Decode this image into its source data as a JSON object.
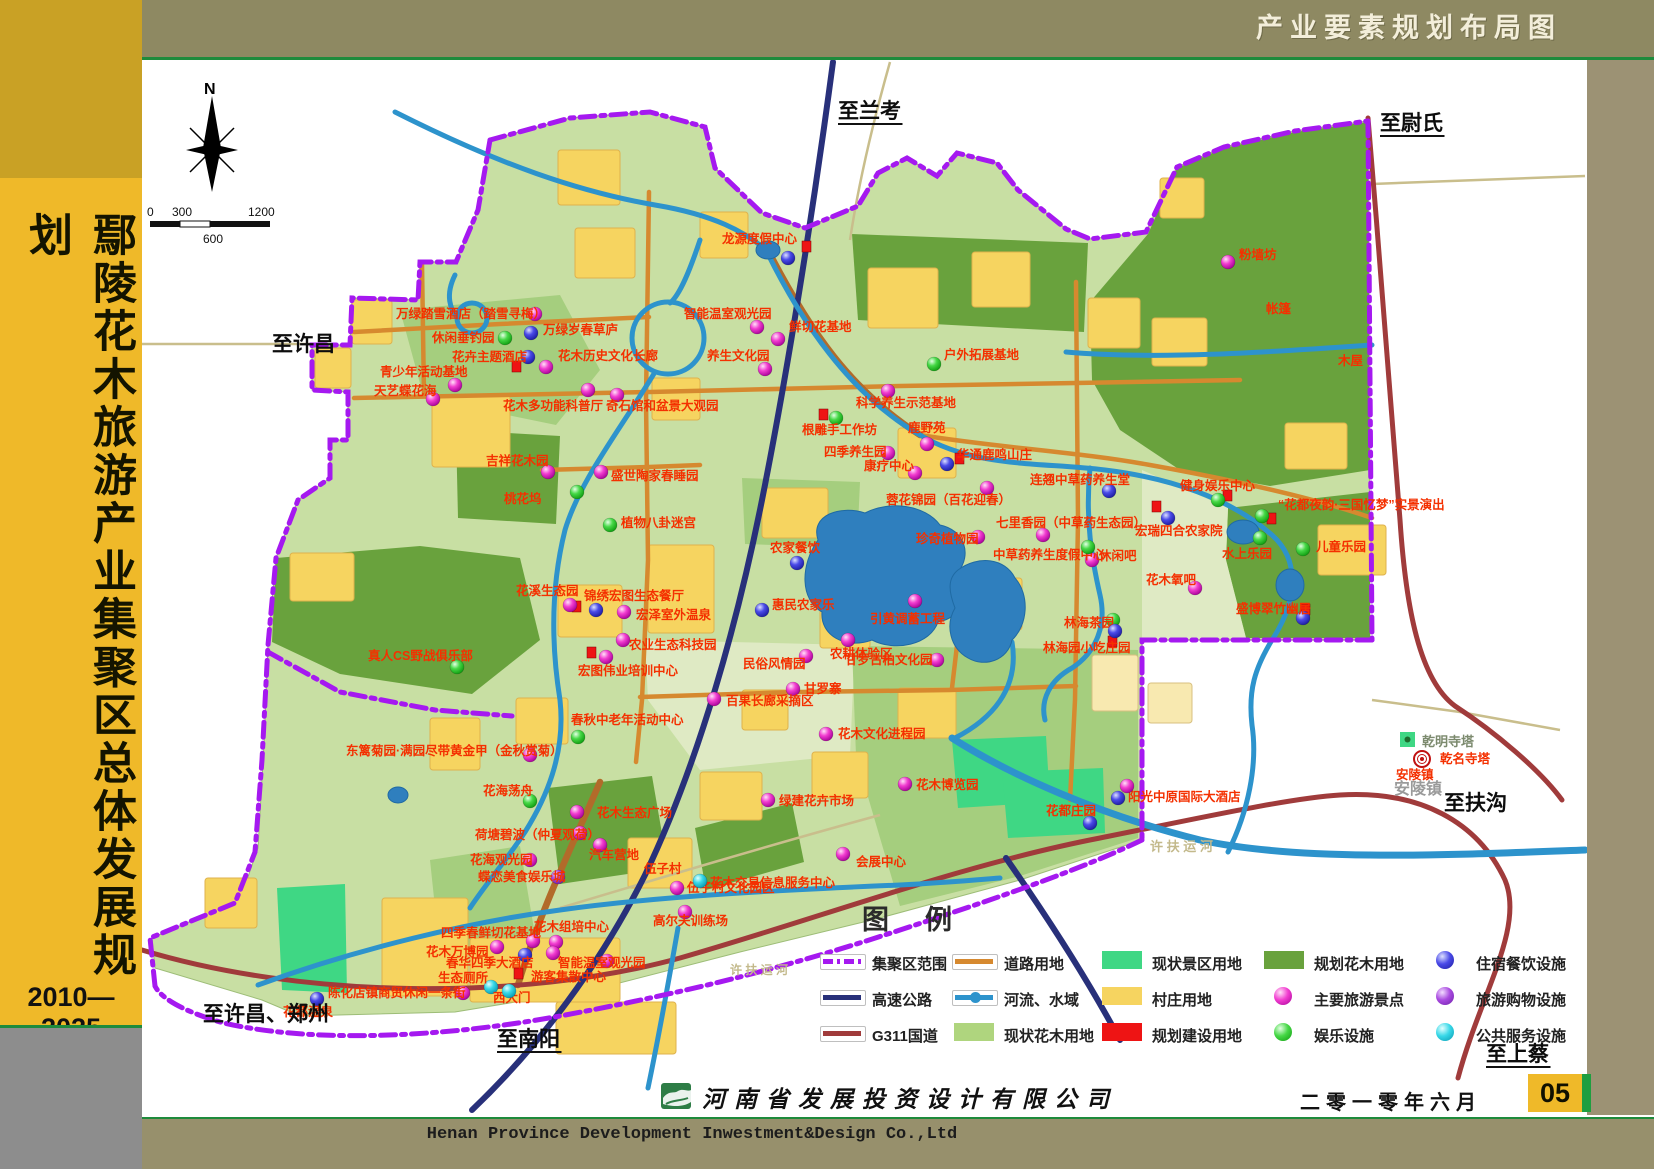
{
  "top_bar": {
    "title": "产业要素规划布局图"
  },
  "sidebar": {
    "title": "鄢陵花木旅游产业集聚区总体发展规划",
    "years": "2010—2025"
  },
  "footer": {
    "company_cn": "河南省发展投资设计有限公司",
    "company_en": "Henan Province Development Inwestment&Design Co.,Ltd",
    "date": "二零一零年六月",
    "page_number": "05"
  },
  "legend": {
    "title": "图例",
    "columns": [
      {
        "x": 820,
        "items": [
          {
            "sw": "line-boundary",
            "label": "集聚区范围"
          },
          {
            "sw": "line-highway",
            "label": "高速公路"
          },
          {
            "sw": "line-g311",
            "label": "G311国道"
          }
        ]
      },
      {
        "x": 952,
        "items": [
          {
            "sw": "line-road",
            "label": "道路用地"
          },
          {
            "sw": "line-river",
            "label": "河流、水域"
          },
          {
            "sw": "patch-flower-current",
            "label": "现状花木用地"
          }
        ]
      },
      {
        "x": 1100,
        "items": [
          {
            "sw": "patch-scenic",
            "label": "现状景区用地"
          },
          {
            "sw": "patch-village",
            "label": "村庄用地"
          },
          {
            "sw": "patch-construction",
            "label": "规划建设用地"
          }
        ]
      },
      {
        "x": 1262,
        "items": [
          {
            "sw": "patch-flower-planned",
            "label": "规划花木用地"
          },
          {
            "sw": "ball-magenta",
            "label": "主要旅游景点"
          },
          {
            "sw": "ball-green",
            "label": "娱乐设施"
          }
        ]
      },
      {
        "x": 1424,
        "items": [
          {
            "sw": "ball-blue",
            "label": "住宿餐饮设施"
          },
          {
            "sw": "ball-purple",
            "label": "旅游购物设施"
          },
          {
            "sw": "ball-cyan",
            "label": "公共服务设施"
          }
        ]
      }
    ]
  },
  "map": {
    "compass_n": "N",
    "scale": {
      "t0": "0",
      "t1": "300",
      "t2": "1200",
      "mid": "600"
    },
    "directions": [
      {
        "t": "至兰考",
        "x": 838,
        "y": 118,
        "u": true
      },
      {
        "t": "至尉氏",
        "x": 1380,
        "y": 130,
        "u": true
      },
      {
        "t": "至许昌",
        "x": 272,
        "y": 351,
        "u": false
      },
      {
        "t": "至扶沟",
        "x": 1444,
        "y": 810,
        "u": false
      },
      {
        "t": "至上蔡",
        "x": 1486,
        "y": 1061,
        "u": true
      },
      {
        "t": "至许昌、郑州",
        "x": 203,
        "y": 1021,
        "u": false
      },
      {
        "t": "至南阳",
        "x": 497,
        "y": 1046,
        "u": true
      }
    ],
    "pois": [
      {
        "l": "龙源度假中心",
        "m": "blue",
        "x": 788,
        "y": 258,
        "lx": 722,
        "ly": 243,
        "rs": [
          806,
          246
        ]
      },
      {
        "l": "万绿踏雪酒店（踏雪寻梅）",
        "m": "magenta",
        "x": 535,
        "y": 314,
        "lx": 396,
        "ly": 318
      },
      {
        "l": "休闲垂钓园",
        "m": "green",
        "x": 505,
        "y": 338,
        "lx": 432,
        "ly": 342
      },
      {
        "l": "万绿岁春草庐",
        "m": "blue",
        "x": 531,
        "y": 333,
        "lx": 543,
        "ly": 334
      },
      {
        "l": "花卉主题酒店",
        "m": "blue",
        "x": 528,
        "y": 357,
        "lx": 452,
        "ly": 361,
        "rs": [
          516,
          366
        ]
      },
      {
        "l": "花木历史文化长廊",
        "m": "magenta",
        "x": 546,
        "y": 367,
        "lx": 558,
        "ly": 360
      },
      {
        "l": "智能温室观光园",
        "m": "magenta",
        "x": 757,
        "y": 327,
        "lx": 684,
        "ly": 318
      },
      {
        "l": "鲜切花基地",
        "m": "magenta",
        "x": 778,
        "y": 339,
        "lx": 789,
        "ly": 331
      },
      {
        "l": "养生文化园",
        "m": "magenta",
        "x": 765,
        "y": 369,
        "lx": 707,
        "ly": 360
      },
      {
        "l": "户外拓展基地",
        "m": "green",
        "x": 934,
        "y": 364,
        "lx": 944,
        "ly": 359
      },
      {
        "l": "科学养生示范基地",
        "m": "magenta",
        "x": 888,
        "y": 391,
        "lx": 856,
        "ly": 407
      },
      {
        "l": "根雕手工作坊",
        "m": "green",
        "x": 836,
        "y": 418,
        "lx": 802,
        "ly": 434,
        "rs": [
          823,
          414
        ]
      },
      {
        "l": "鹿野苑",
        "m": "magenta",
        "x": 927,
        "y": 444,
        "lx": 908,
        "ly": 432
      },
      {
        "l": "四季养生园",
        "m": "magenta",
        "x": 888,
        "y": 453,
        "lx": 824,
        "ly": 456
      },
      {
        "l": "康疗中心",
        "m": "magenta",
        "x": 915,
        "y": 473,
        "lx": 864,
        "ly": 470
      },
      {
        "l": "华通鹿鸣山庄",
        "m": "blue",
        "x": 947,
        "y": 464,
        "lx": 957,
        "ly": 459,
        "rs": [
          959,
          458
        ]
      },
      {
        "l": "蓉花锦园（百花迎春）",
        "m": "magenta",
        "x": 987,
        "y": 488,
        "lx": 886,
        "ly": 504
      },
      {
        "l": "连翘中草药养生堂",
        "m": "blue",
        "x": 1109,
        "y": 491,
        "lx": 1030,
        "ly": 484
      },
      {
        "l": "七里香园（中草药生态园）",
        "m": "magenta",
        "x": 1043,
        "y": 535,
        "lx": 996,
        "ly": 527
      },
      {
        "l": "宏瑞四合农家院",
        "m": "blue",
        "x": 1168,
        "y": 518,
        "lx": 1135,
        "ly": 535,
        "rs": [
          1156,
          506
        ]
      },
      {
        "l": "珍奇植物园",
        "m": "magenta",
        "x": 978,
        "y": 537,
        "lx": 916,
        "ly": 543
      },
      {
        "l": "中草药养生度假中心",
        "m": "magenta",
        "x": 1092,
        "y": 560,
        "lx": 993,
        "ly": 559
      },
      {
        "l": "休闲吧",
        "m": "green",
        "x": 1088,
        "y": 547,
        "lx": 1099,
        "ly": 560
      },
      {
        "l": "花木氧吧",
        "m": "magenta",
        "x": 1195,
        "y": 588,
        "lx": 1146,
        "ly": 584
      },
      {
        "l": "宏泽室外温泉",
        "m": "magenta",
        "x": 624,
        "y": 612,
        "lx": 636,
        "ly": 619
      },
      {
        "l": "锦绣宏图生态餐厅",
        "m": "blue",
        "x": 596,
        "y": 610,
        "lx": 584,
        "ly": 600,
        "rs": [
          576,
          606
        ]
      },
      {
        "l": "花溪生态园",
        "m": "magenta",
        "x": 570,
        "y": 605,
        "lx": 516,
        "ly": 595
      },
      {
        "l": "农业生态科技园",
        "m": "magenta",
        "x": 623,
        "y": 640,
        "lx": 629,
        "ly": 649
      },
      {
        "l": "宏图伟业培训中心",
        "m": "magenta",
        "x": 606,
        "y": 657,
        "lx": 578,
        "ly": 675,
        "rs": [
          591,
          652
        ]
      },
      {
        "l": "真人CS野战俱乐部",
        "m": "green",
        "x": 457,
        "y": 667,
        "lx": 368,
        "ly": 660
      },
      {
        "l": "春秋中老年活动中心",
        "m": "green",
        "x": 578,
        "y": 737,
        "lx": 571,
        "ly": 724
      },
      {
        "l": "东篱菊园·满园尽带黄金甲（金秋赏菊）",
        "m": "magenta",
        "x": 530,
        "y": 755,
        "lx": 346,
        "ly": 755
      },
      {
        "l": "花海荡舟",
        "m": "green",
        "x": 530,
        "y": 801,
        "lx": 483,
        "ly": 795
      },
      {
        "l": "花木生态广场",
        "m": "magenta",
        "x": 577,
        "y": 812,
        "lx": 597,
        "ly": 817
      },
      {
        "l": "荷塘碧波（仲夏观荷）",
        "m": "magenta",
        "x": 580,
        "y": 833,
        "lx": 475,
        "ly": 839
      },
      {
        "l": "花海观光园",
        "m": "magenta",
        "x": 530,
        "y": 860,
        "lx": 470,
        "ly": 864
      },
      {
        "l": "蝶恋美食娱乐城",
        "m": "purple",
        "x": 558,
        "y": 877,
        "lx": 478,
        "ly": 881
      },
      {
        "l": "汽车营地",
        "m": "magenta",
        "x": 600,
        "y": 845,
        "lx": 589,
        "ly": 859
      },
      {
        "l": "伍子村",
        "m": "none",
        "lx": 644,
        "ly": 873
      },
      {
        "l": "伍子村文化园区",
        "m": "magenta",
        "x": 677,
        "y": 888,
        "lx": 687,
        "ly": 892
      },
      {
        "l": "高尔夫训练场",
        "m": "magenta",
        "x": 685,
        "y": 912,
        "lx": 653,
        "ly": 925
      },
      {
        "l": "花木交易信息服务中心",
        "m": "cyan",
        "x": 700,
        "y": 881,
        "lx": 710,
        "ly": 887
      },
      {
        "l": "会展中心",
        "m": "magenta",
        "x": 843,
        "y": 854,
        "lx": 856,
        "ly": 866
      },
      {
        "l": "绿建花卉市场",
        "m": "magenta",
        "x": 768,
        "y": 800,
        "lx": 779,
        "ly": 805
      },
      {
        "l": "花木博览园",
        "m": "magenta",
        "x": 905,
        "y": 784,
        "lx": 916,
        "ly": 789
      },
      {
        "l": "花木文化进程园",
        "m": "magenta",
        "x": 826,
        "y": 734,
        "lx": 838,
        "ly": 738
      },
      {
        "l": "甘罗寨",
        "m": "magenta",
        "x": 793,
        "y": 689,
        "lx": 804,
        "ly": 693
      },
      {
        "l": "民俗风情园",
        "m": "magenta",
        "x": 806,
        "y": 656,
        "lx": 743,
        "ly": 668
      },
      {
        "l": "甘罗古柏文化园",
        "m": "magenta",
        "x": 937,
        "y": 660,
        "lx": 845,
        "ly": 664
      },
      {
        "l": "百果长廊采摘区",
        "m": "magenta",
        "x": 714,
        "y": 699,
        "lx": 726,
        "ly": 705
      },
      {
        "l": "农耕体验区",
        "m": "magenta",
        "x": 848,
        "y": 640,
        "lx": 830,
        "ly": 658
      },
      {
        "l": "引黄调蓄工程",
        "m": "magenta",
        "x": 915,
        "y": 601,
        "lx": 870,
        "ly": 623
      },
      {
        "l": "惠民农家乐",
        "m": "blue",
        "x": 762,
        "y": 610,
        "lx": 772,
        "ly": 609
      },
      {
        "l": "农家餐饮",
        "m": "blue",
        "x": 797,
        "y": 563,
        "lx": 770,
        "ly": 552
      },
      {
        "l": "林海茶园",
        "m": "green",
        "x": 1113,
        "y": 620,
        "lx": 1064,
        "ly": 627
      },
      {
        "l": "林海园小吃庄园",
        "m": "blue",
        "x": 1115,
        "y": 631,
        "lx": 1043,
        "ly": 652,
        "rs": [
          1112,
          641
        ]
      },
      {
        "l": "健身娱乐中心",
        "m": "green",
        "x": 1218,
        "y": 500,
        "lx": 1180,
        "ly": 490,
        "rs": [
          1227,
          495
        ]
      },
      {
        "l": "“花都夜韵·三国忆梦”实景演出",
        "m": "green",
        "x": 1262,
        "y": 516,
        "lx": 1278,
        "ly": 509,
        "rs": [
          1271,
          518
        ]
      },
      {
        "l": "儿童乐园",
        "m": "green",
        "x": 1303,
        "y": 549,
        "lx": 1316,
        "ly": 551
      },
      {
        "l": "水上乐园",
        "m": "green",
        "x": 1260,
        "y": 538,
        "lx": 1222,
        "ly": 558
      },
      {
        "l": "盛博翠竹幽居",
        "m": "blue",
        "x": 1303,
        "y": 618,
        "lx": 1236,
        "ly": 613,
        "rs": [
          1305,
          609
        ]
      },
      {
        "l": "花都庄园",
        "m": "blue",
        "x": 1090,
        "y": 823,
        "lx": 1046,
        "ly": 815
      },
      {
        "l": "阳光中原国际大酒店",
        "m": "blue",
        "x": 1118,
        "y": 798,
        "lx": 1128,
        "ly": 801
      },
      {
        "l": "乾名寺塔",
        "m": "target",
        "x": 1422,
        "y": 759,
        "lx": 1440,
        "ly": 763
      },
      {
        "l": "安陵镇",
        "m": "none",
        "lx": 1396,
        "ly": 779
      },
      {
        "l": "花都温泉",
        "m": "blue",
        "x": 317,
        "y": 999,
        "lx": 283,
        "ly": 1016
      },
      {
        "l": "陈化店镇商贸休闲一条街",
        "m": "magenta",
        "x": 463,
        "y": 993,
        "lx": 328,
        "ly": 997
      },
      {
        "l": "生态厕所",
        "m": "cyan",
        "x": 491,
        "y": 987,
        "lx": 438,
        "ly": 982
      },
      {
        "l": "游客集散中心",
        "m": "none",
        "lx": 531,
        "ly": 981,
        "rs": [
          518,
          973
        ]
      },
      {
        "l": "西大门",
        "m": "none",
        "lx": 493,
        "ly": 1002
      },
      {
        "l": "春华四季大酒店",
        "m": "blue",
        "x": 525,
        "y": 955,
        "lx": 446,
        "ly": 967
      },
      {
        "l": "花木万博园",
        "m": "magenta",
        "x": 497,
        "y": 947,
        "lx": 426,
        "ly": 956
      },
      {
        "l": "四季春鲜切花基地",
        "m": "magenta",
        "x": 533,
        "y": 941,
        "lx": 441,
        "ly": 937
      },
      {
        "l": "花木组培中心",
        "m": "magenta",
        "x": 556,
        "y": 942,
        "lx": 534,
        "ly": 931
      },
      {
        "l": "智能温室观光园",
        "m": "magenta",
        "x": 607,
        "y": 961,
        "lx": 558,
        "ly": 967
      },
      {
        "l": "青少年活动基地",
        "m": "magenta",
        "x": 455,
        "y": 385,
        "lx": 380,
        "ly": 376
      },
      {
        "l": "天艺蝶花海",
        "m": "magenta",
        "x": 433,
        "y": 399,
        "lx": 374,
        "ly": 395
      },
      {
        "l": "花木多功能科普厅",
        "m": "magenta",
        "x": 588,
        "y": 390,
        "lx": 503,
        "ly": 410
      },
      {
        "l": "奇石馆和盆景大观园",
        "m": "magenta",
        "x": 617,
        "y": 395,
        "lx": 606,
        "ly": 410
      },
      {
        "l": "吉祥花木园",
        "m": "magenta",
        "x": 548,
        "y": 472,
        "lx": 486,
        "ly": 465
      },
      {
        "l": "盛世陶家春睡园",
        "m": "magenta",
        "x": 601,
        "y": 472,
        "lx": 611,
        "ly": 480
      },
      {
        "l": "桃花坞",
        "m": "green",
        "x": 577,
        "y": 492,
        "lx": 504,
        "ly": 503
      },
      {
        "l": "植物八卦迷宫",
        "m": "green",
        "x": 610,
        "y": 525,
        "lx": 621,
        "ly": 527
      },
      {
        "l": "粉墙坊",
        "m": "magenta",
        "x": 1228,
        "y": 262,
        "lx": 1239,
        "ly": 259
      },
      {
        "l": "帐篷",
        "m": "none",
        "lx": 1266,
        "ly": 313
      },
      {
        "l": "木屋",
        "m": "none",
        "lx": 1338,
        "ly": 365
      }
    ],
    "extra_markers": [
      {
        "m": "magenta",
        "x": 1127,
        "y": 786
      },
      {
        "m": "cyan",
        "x": 509,
        "y": 991
      },
      {
        "m": "magenta",
        "x": 553,
        "y": 953
      }
    ],
    "base_labels": [
      {
        "t": "乾明寺塔",
        "x": 1422,
        "y": 746,
        "c": "#7c8a6e",
        "fs": 13,
        "sq": [
          1400,
          732
        ]
      },
      {
        "t": "安陵镇",
        "x": 1394,
        "y": 794,
        "c": "#9a9a9a",
        "fs": 16
      },
      {
        "t": "许 扶 运 河",
        "x": 1150,
        "y": 851,
        "c": "#c3b98b",
        "fs": 13
      },
      {
        "t": "许 扶 运 河",
        "x": 730,
        "y": 974,
        "c": "#c3b98b",
        "fs": 12
      }
    ]
  },
  "colors": {
    "accent_gold": "#EFB929",
    "olive_top": "#8E8962",
    "olive_right": "#9C9274",
    "olive_bottom": "#97906C",
    "green_rule": "#1E8B3C",
    "map_light": "#C8DFA3",
    "map_mid": "#A5CE7E",
    "map_dark": "#69A23D",
    "scenic": "#3FD784",
    "village": "#F6D460",
    "water": "#2D93CC",
    "lake": "#2F7FBE",
    "road": "#D6892F",
    "highway": "#28307A",
    "g311": "#A03B3B",
    "boundary": "#A519F0",
    "construction": "#EE1414",
    "poi_label": "#F43000",
    "ball_magenta": "#E93CCB",
    "ball_blue": "#4444E0",
    "ball_green": "#46D846",
    "ball_purple": "#A94AE0",
    "ball_cyan": "#38D8E8"
  }
}
